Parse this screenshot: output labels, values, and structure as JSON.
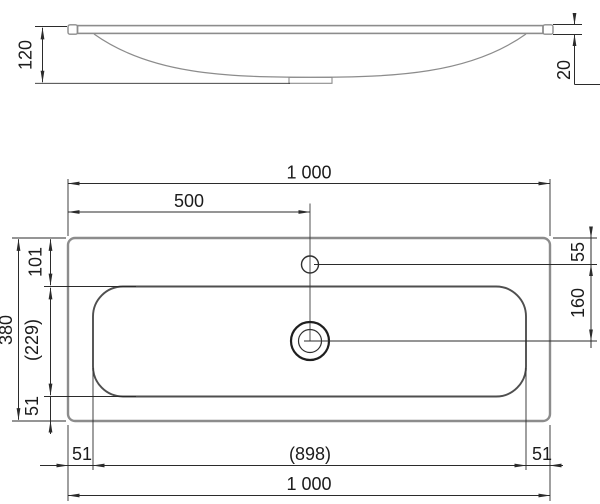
{
  "drawing": {
    "type": "washbasin-dimension-drawing",
    "views": [
      "side-profile",
      "plan-top-view"
    ]
  },
  "labels": {
    "side_height": "120",
    "side_rim": "20",
    "top_width": "1 000",
    "tap_center": "500",
    "depth": "380",
    "edge_to_bowl_top": "101",
    "bowl_depth": "(229)",
    "bowl_to_edge_bottom": "51",
    "edge_to_bowl_left": "51",
    "bowl_width": "(898)",
    "edge_to_bowl_right": "51",
    "bottom_width": "1 000",
    "edge_to_tap": "55",
    "tap_to_drain": "160"
  },
  "colors": {
    "dim": "#2b2b2b",
    "object": "#8c8c8c",
    "basin": "#4f4f4f",
    "text": "#1c1c1c",
    "bg": "#ffffff"
  }
}
